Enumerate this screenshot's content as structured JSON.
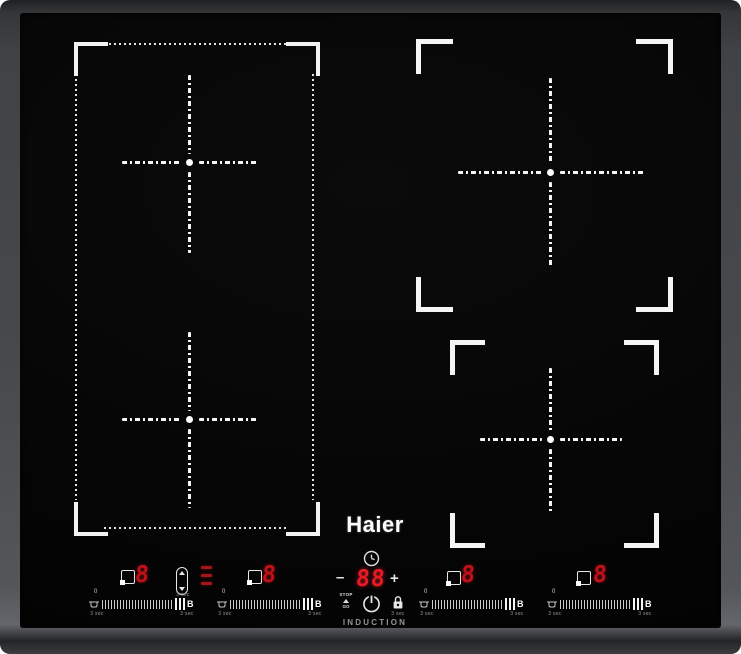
{
  "brand": {
    "logo": "Haier",
    "induction_label": "INDUCTION"
  },
  "timer": {
    "value": "88",
    "minus": "–",
    "plus": "+"
  },
  "stop_go": {
    "top": "STOP",
    "bottom": "GO"
  },
  "lock": {
    "hint": "3 sec"
  },
  "bridge": {
    "hint": "3 sec"
  },
  "displays": [
    {
      "value": "8"
    },
    {
      "value": "8"
    },
    {
      "value": "8"
    },
    {
      "value": "8"
    }
  ],
  "sliders": [
    {
      "zero": "0",
      "boost": "B",
      "hint_left": "3 sec",
      "hint_right": "3 sec"
    },
    {
      "zero": "0",
      "boost": "B",
      "hint_left": "3 sec",
      "hint_right": "3 sec"
    },
    {
      "zero": "0",
      "boost": "B",
      "hint_left": "3 sec",
      "hint_right": "3 sec"
    },
    {
      "zero": "0",
      "boost": "B",
      "hint_left": "3 sec",
      "hint_right": "3 sec"
    }
  ],
  "icons": {
    "clock-icon": "circle with clock hands",
    "power-icon": "power symbol circle with line",
    "lock-icon": "padlock",
    "stop-go-triangle-icon": "small up triangle",
    "zone-select-icon": "square with corner dot",
    "bridge-icon": "vertical pill with up/down triangles",
    "pan-icon": "small cooking pot",
    "flex-indicator-icon": "three red dashes",
    "crosshair": "dash-dot cross with center dot",
    "corner-bracket": "L-shaped zone marker"
  },
  "colors": {
    "glass_black": "#050505",
    "frame_gray": "#4a4d4f",
    "led_red": "#e81a24",
    "graphics_white": "#f2f2f2"
  }
}
